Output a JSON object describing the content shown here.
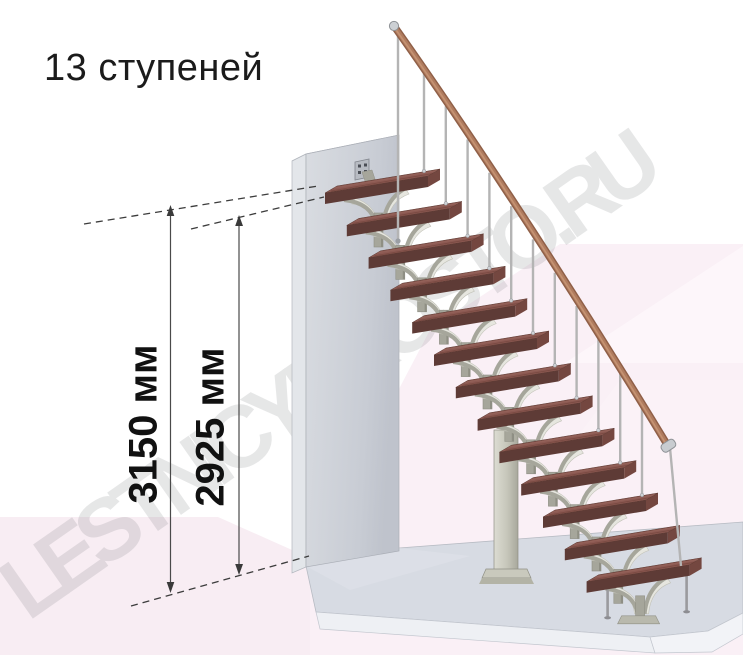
{
  "title": "13 ступеней",
  "staircase": {
    "steps_count": 13,
    "steps_word": "ступеней"
  },
  "dimensions": {
    "total_height": {
      "value": "3150",
      "unit": "мм",
      "label": "3150 мм"
    },
    "to_top_tread": {
      "value": "2925",
      "unit": "мм",
      "label": "2925 мм"
    }
  },
  "watermark": {
    "text": "LESTNICYPROSTO.RU"
  },
  "colors": {
    "tread_top": "#8c5952",
    "tread_front": "#5e3b36",
    "tread_side": "#744740",
    "tread_streak": "#6e4038",
    "handrail_dark": "#8f5f47",
    "handrail_mid": "#b07c5f",
    "handrail_light": "#c99877",
    "metal_gray": "#a6a69b",
    "metal_light": "#e6e6df",
    "baluster": "#b4b4b4",
    "wall_face": "#ccd1d8",
    "wall_side": "#e3e6ea",
    "slab_top": "#d7dbe3",
    "slab_front": "#eef0f4",
    "pink_left": "#f8edf3",
    "pink_right": "#faf0f6",
    "pink_bright": "#fdf6fa",
    "dim_line": "#3c3c3c",
    "text_color": "#1b1b1b"
  }
}
